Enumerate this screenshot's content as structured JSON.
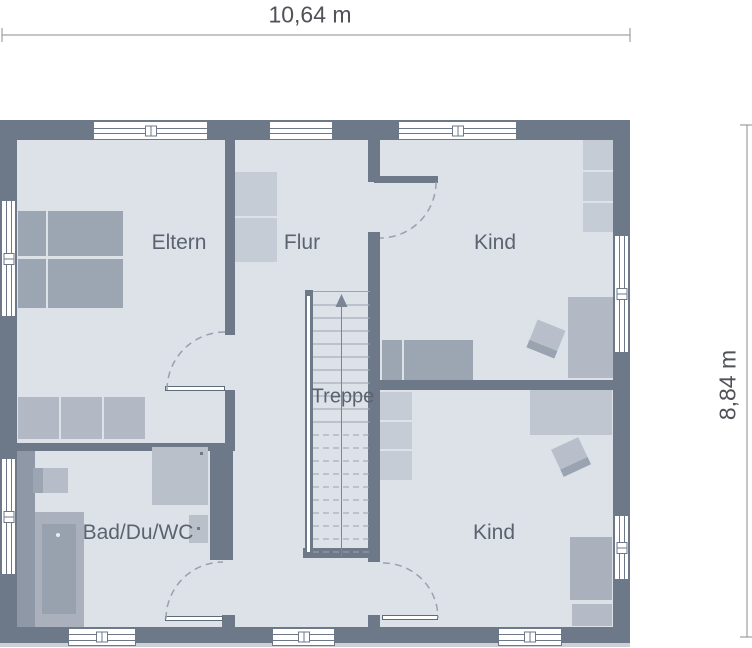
{
  "floor_plan": {
    "dimensions": {
      "width_label": "10,64 m",
      "height_label": "8,84 m"
    },
    "rooms": {
      "eltern": {
        "label": "Eltern"
      },
      "flur": {
        "label": "Flur"
      },
      "kind_top": {
        "label": "Kind"
      },
      "treppe": {
        "label": "Treppe"
      },
      "bad": {
        "label": "Bad/Du/WC"
      },
      "kind_bottom": {
        "label": "Kind"
      }
    },
    "colors": {
      "wall": "#6d7889",
      "floor": "#dde2e8",
      "furniture_light": "#c6ccd5",
      "furniture_mid": "#b2b9c4",
      "furniture_dark": "#9ca5b2",
      "label_text": "#5b6370",
      "dimension_text": "#515257"
    }
  }
}
